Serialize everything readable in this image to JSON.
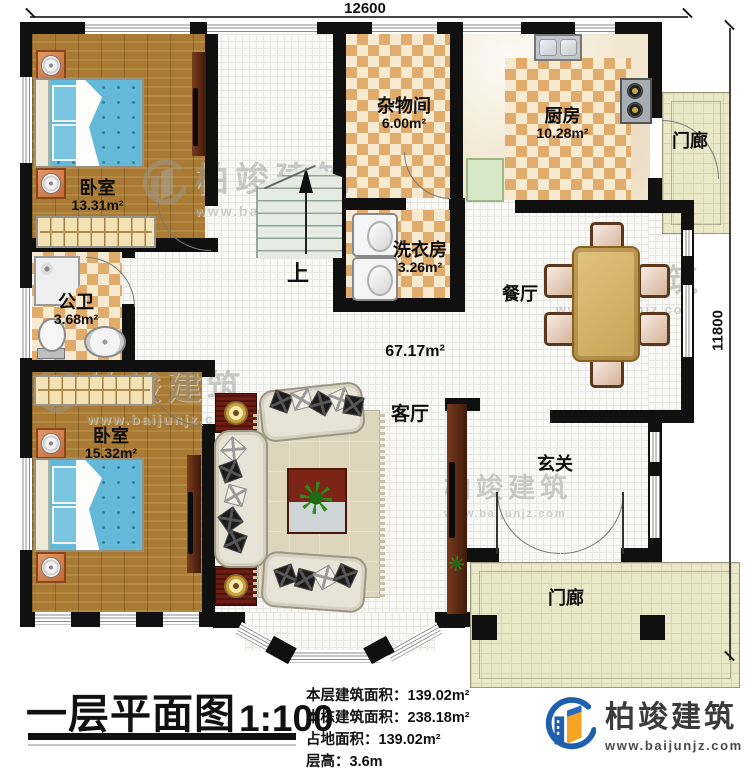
{
  "dimensions": {
    "top": "12600",
    "right": "11800"
  },
  "rooms": {
    "bedroom1": {
      "name": "卧室",
      "area": "13.31m²"
    },
    "storage": {
      "name": "杂物间",
      "area": "6.00m²"
    },
    "kitchen": {
      "name": "厨房",
      "area": "10.28m²"
    },
    "porch_top": {
      "name": "门廊"
    },
    "laundry": {
      "name": "洗衣房",
      "area": "3.26m²"
    },
    "bathroom": {
      "name": "公卫",
      "area": "3.68m²"
    },
    "dining": {
      "name": "餐厅"
    },
    "living": {
      "name": "客厅",
      "area": "67.17m²"
    },
    "bedroom2": {
      "name": "卧室",
      "area": "15.32m²"
    },
    "foyer": {
      "name": "玄关"
    },
    "porch_bottom": {
      "name": "门廊"
    }
  },
  "stairs": {
    "up_label": "上"
  },
  "title_block": {
    "title": "一层平面图",
    "scale": "1:100",
    "info_lines": [
      {
        "label": "本层建筑面积：",
        "value": "139.02m²"
      },
      {
        "label": "本栋建筑面积：",
        "value": "238.18m²"
      },
      {
        "label": "占地面积：",
        "value": "139.02m²"
      },
      {
        "label": "层高：",
        "value": "3.6m"
      }
    ]
  },
  "brand": {
    "name": "柏竣建筑",
    "website": "www.baijunjz.com"
  },
  "watermark": {
    "text": "柏竣建筑",
    "site": "www.baijunjz.com"
  },
  "colors": {
    "wall": "#101010",
    "wood_floor": "#a87a33",
    "tile_tan": "#e0ab6b",
    "tile_cream": "#f7ead0",
    "bed_blue": "#64b9d8",
    "brand_blue": "#1e5fae",
    "brand_orange": "#f6a321"
  }
}
